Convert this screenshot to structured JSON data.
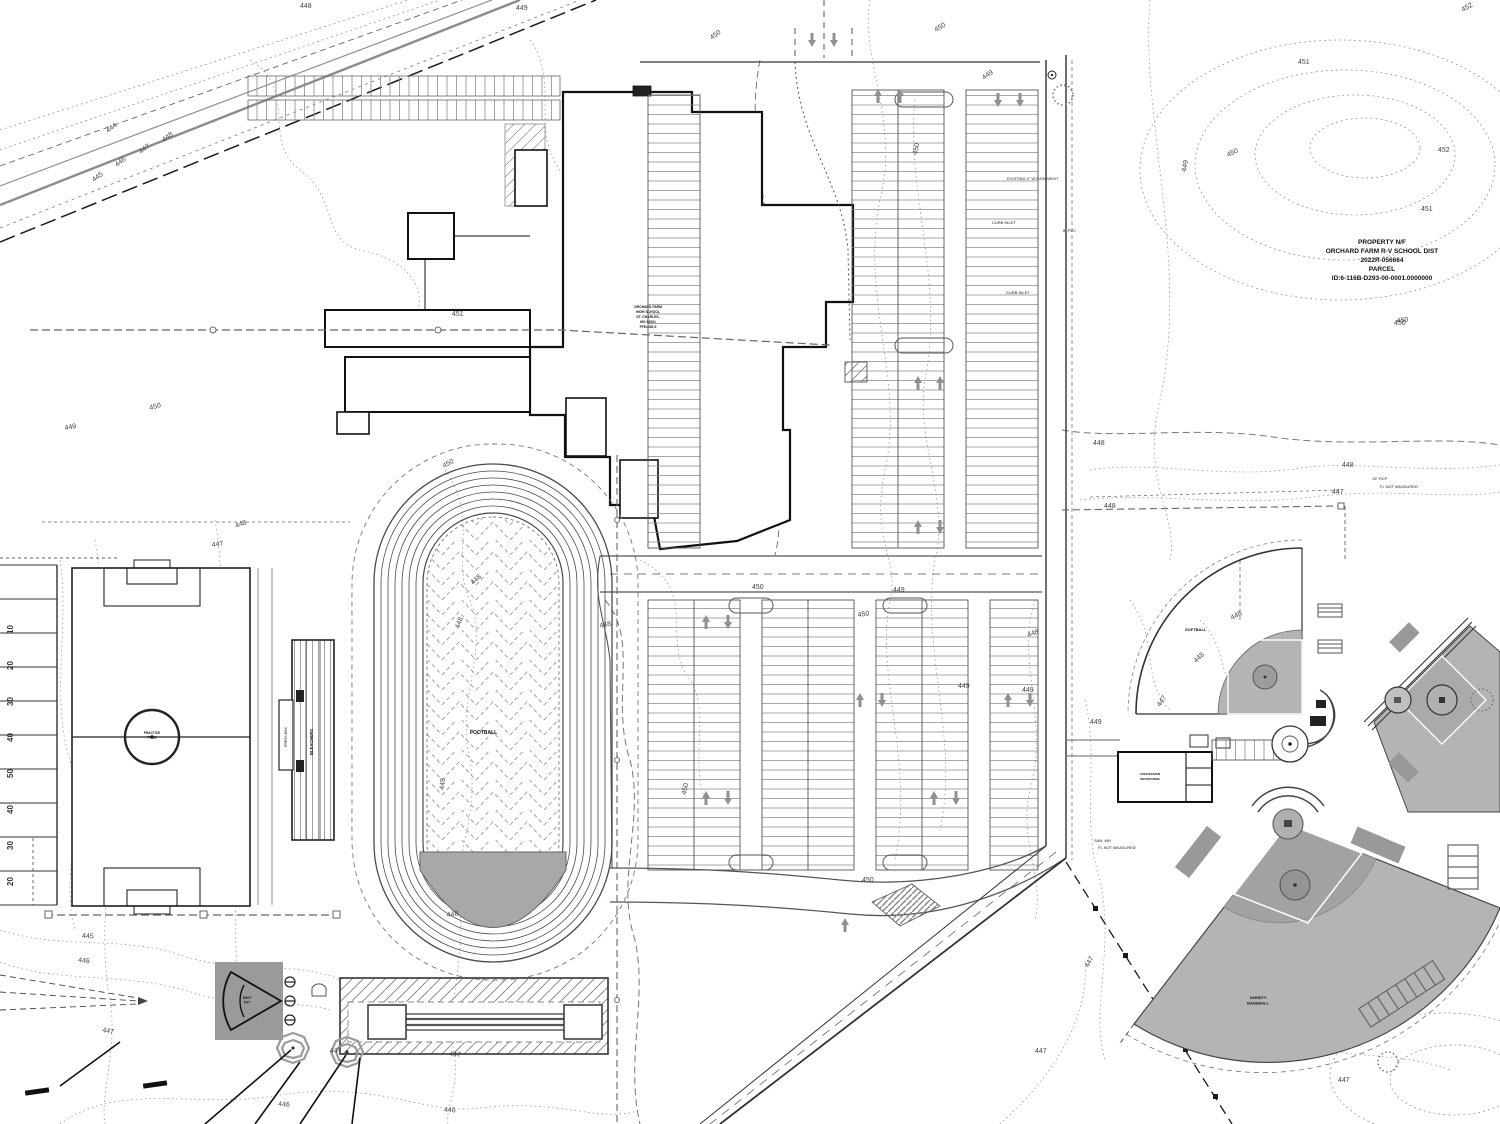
{
  "colors": {
    "ink": "#1a1a1a",
    "line_gray": "#888888",
    "contour_gray": "#999999",
    "field_gray": "#b4b4b4",
    "infield_gray": "#a2a2a2",
    "pad_gray": "#9a9a9a",
    "arrow_gray": "#909090"
  },
  "annotations": {
    "property_block": {
      "lines": [
        "PROPERTY N/F",
        "ORCHARD FARM R-V SCHOOL DIST",
        "2022R-056664",
        "PARCEL",
        "ID:6-116B-D293-00-0001.0000000"
      ]
    },
    "building_block": {
      "lines": [
        "ORCHARD FARM",
        "HIGH SCHOOL",
        "ST. CHARLES,",
        "MO 63301",
        "FFE=451.5"
      ]
    }
  },
  "labels": {
    "infield": "FOOTBALL",
    "bleachers": "BLEACHERS",
    "pressbox": "PRESS BOX",
    "shotput_1": "SHOT",
    "shotput_2": "PUT",
    "softball": "SOFTBALL",
    "varsity_1": "VARSITY",
    "varsity_2": "BASEBALL",
    "concession_1": "CONCESSION",
    "concession_2": "RESTROOMS",
    "practice_1": "PRACTICE",
    "practice_2": "FIELD"
  },
  "yard_numbers": [
    {
      "t": "10",
      "x": 13,
      "y": 634
    },
    {
      "t": "20",
      "x": 13,
      "y": 670
    },
    {
      "t": "30",
      "x": 13,
      "y": 706
    },
    {
      "t": "40",
      "x": 13,
      "y": 742
    },
    {
      "t": "50",
      "x": 13,
      "y": 778
    },
    {
      "t": "40",
      "x": 13,
      "y": 814
    },
    {
      "t": "30",
      "x": 13,
      "y": 850
    },
    {
      "t": "20",
      "x": 13,
      "y": 886
    }
  ],
  "contour_labels": [
    {
      "t": "448",
      "x": 300,
      "y": 8,
      "r": 0
    },
    {
      "t": "449",
      "x": 516,
      "y": 10,
      "r": 0
    },
    {
      "t": "450",
      "x": 712,
      "y": 40,
      "r": -38
    },
    {
      "t": "450",
      "x": 936,
      "y": 32,
      "r": -30
    },
    {
      "t": "449",
      "x": 984,
      "y": 80,
      "r": -35
    },
    {
      "t": "444",
      "x": 108,
      "y": 133,
      "r": -36
    },
    {
      "t": "445",
      "x": 94,
      "y": 182,
      "r": -36
    },
    {
      "t": "446",
      "x": 117,
      "y": 167,
      "r": -36
    },
    {
      "t": "447",
      "x": 141,
      "y": 154,
      "r": -36
    },
    {
      "t": "448",
      "x": 164,
      "y": 142,
      "r": -36
    },
    {
      "t": "451",
      "x": 452,
      "y": 316,
      "r": 0
    },
    {
      "t": "450",
      "x": 150,
      "y": 410,
      "r": -15
    },
    {
      "t": "449",
      "x": 65,
      "y": 430,
      "r": -10
    },
    {
      "t": "447",
      "x": 212,
      "y": 547,
      "r": -8
    },
    {
      "t": "448",
      "x": 236,
      "y": 528,
      "r": -20
    },
    {
      "t": "450",
      "x": 444,
      "y": 468,
      "r": -28
    },
    {
      "t": "448",
      "x": 473,
      "y": 585,
      "r": -42
    },
    {
      "t": "448",
      "x": 459,
      "y": 629,
      "r": -70
    },
    {
      "t": "449",
      "x": 444,
      "y": 790,
      "r": -85
    },
    {
      "t": "448",
      "x": 447,
      "y": 917,
      "r": -8
    },
    {
      "t": "447",
      "x": 449,
      "y": 1056,
      "r": 4
    },
    {
      "t": "446",
      "x": 444,
      "y": 1112,
      "r": 2
    },
    {
      "t": "445",
      "x": 82,
      "y": 938,
      "r": 2
    },
    {
      "t": "446",
      "x": 78,
      "y": 962,
      "r": 6
    },
    {
      "t": "447",
      "x": 102,
      "y": 1032,
      "r": 10
    },
    {
      "t": "447",
      "x": 330,
      "y": 1053,
      "r": -4
    },
    {
      "t": "450",
      "x": 917,
      "y": 155,
      "r": -78
    },
    {
      "t": "449",
      "x": 893,
      "y": 592,
      "r": 0
    },
    {
      "t": "450",
      "x": 752,
      "y": 589,
      "r": 0
    },
    {
      "t": "450",
      "x": 858,
      "y": 617,
      "r": -8
    },
    {
      "t": "448",
      "x": 600,
      "y": 628,
      "r": -12
    },
    {
      "t": "450",
      "x": 686,
      "y": 795,
      "r": -78
    },
    {
      "t": "449",
      "x": 958,
      "y": 688,
      "r": 0
    },
    {
      "t": "449",
      "x": 1022,
      "y": 692,
      "r": 0
    },
    {
      "t": "448",
      "x": 1028,
      "y": 637,
      "r": -18
    },
    {
      "t": "450",
      "x": 862,
      "y": 882,
      "r": 0
    },
    {
      "t": "448",
      "x": 1342,
      "y": 467,
      "r": 0
    },
    {
      "t": "447",
      "x": 1332,
      "y": 494,
      "r": 0
    },
    {
      "t": "448",
      "x": 1104,
      "y": 508,
      "r": 0
    },
    {
      "t": "448",
      "x": 1232,
      "y": 620,
      "r": -28
    },
    {
      "t": "448",
      "x": 1196,
      "y": 663,
      "r": -42
    },
    {
      "t": "447",
      "x": 1160,
      "y": 707,
      "r": -55
    },
    {
      "t": "449",
      "x": 1090,
      "y": 724,
      "r": 0
    },
    {
      "t": "447",
      "x": 1088,
      "y": 968,
      "r": -60
    },
    {
      "t": "447",
      "x": 1035,
      "y": 1053,
      "r": 0
    },
    {
      "t": "447",
      "x": 1338,
      "y": 1082,
      "r": 0
    },
    {
      "t": "451",
      "x": 1298,
      "y": 64,
      "r": 0
    },
    {
      "t": "452",
      "x": 1463,
      "y": 12,
      "r": -30
    },
    {
      "t": "452",
      "x": 1438,
      "y": 152,
      "r": 0
    },
    {
      "t": "451",
      "x": 1421,
      "y": 211,
      "r": 0
    },
    {
      "t": "450",
      "x": 1228,
      "y": 157,
      "r": -25
    },
    {
      "t": "450",
      "x": 1397,
      "y": 323,
      "r": -8
    },
    {
      "t": "449",
      "x": 1186,
      "y": 172,
      "r": -80
    },
    {
      "t": "446",
      "x": 278,
      "y": 1106,
      "r": 4
    },
    {
      "t": "450",
      "x": 1394,
      "y": 325,
      "r": 0
    },
    {
      "t": "448",
      "x": 1093,
      "y": 445,
      "r": 0
    }
  ],
  "flow_arrows": [
    {
      "x": 812,
      "y": 40,
      "d": "d"
    },
    {
      "x": 834,
      "y": 40,
      "d": "d"
    },
    {
      "x": 878,
      "y": 96,
      "d": "u"
    },
    {
      "x": 900,
      "y": 96,
      "d": "u"
    },
    {
      "x": 998,
      "y": 100,
      "d": "d"
    },
    {
      "x": 1020,
      "y": 100,
      "d": "d"
    },
    {
      "x": 918,
      "y": 383,
      "d": "u"
    },
    {
      "x": 940,
      "y": 383,
      "d": "u"
    },
    {
      "x": 918,
      "y": 527,
      "d": "u"
    },
    {
      "x": 940,
      "y": 527,
      "d": "d"
    },
    {
      "x": 706,
      "y": 622,
      "d": "u"
    },
    {
      "x": 728,
      "y": 622,
      "d": "d"
    },
    {
      "x": 706,
      "y": 798,
      "d": "u"
    },
    {
      "x": 728,
      "y": 798,
      "d": "d"
    },
    {
      "x": 860,
      "y": 700,
      "d": "u"
    },
    {
      "x": 882,
      "y": 700,
      "d": "d"
    },
    {
      "x": 934,
      "y": 798,
      "d": "u"
    },
    {
      "x": 956,
      "y": 798,
      "d": "d"
    },
    {
      "x": 1008,
      "y": 700,
      "d": "u"
    },
    {
      "x": 1030,
      "y": 700,
      "d": "d"
    },
    {
      "x": 845,
      "y": 925,
      "d": "u"
    }
  ],
  "notes": [
    {
      "t": "EXISTING 4\" W EASEMENT",
      "x": 1007,
      "y": 180
    },
    {
      "t": "8\" PVC",
      "x": 1063,
      "y": 232
    },
    {
      "t": "CURB INLET",
      "x": 992,
      "y": 224
    },
    {
      "t": "CURB INLET",
      "x": 1006,
      "y": 294
    },
    {
      "t": "15\" RCP",
      "x": 1372,
      "y": 480
    },
    {
      "t": "FL NOT MEASURED",
      "x": 1380,
      "y": 488
    },
    {
      "t": "SAN. MH",
      "x": 1094,
      "y": 842
    },
    {
      "t": "FL NOT MEASURED",
      "x": 1098,
      "y": 849
    }
  ]
}
